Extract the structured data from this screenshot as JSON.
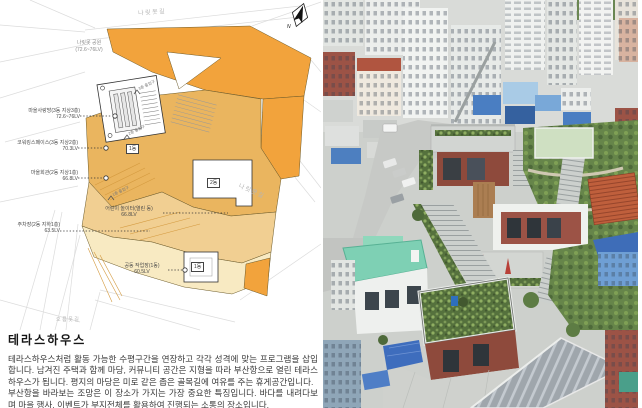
{
  "plan": {
    "compass_label": "N",
    "park": {
      "name": "나릿못 공원",
      "level": "(72.6~76LV)"
    },
    "streets": [
      {
        "text": "나릿못길"
      },
      {
        "text": "나릿못길"
      },
      {
        "text": "오름못길"
      }
    ],
    "callouts": [
      {
        "name": "마을사랑방(3동 지상3층)",
        "level": "72.6~76LV"
      },
      {
        "name": "코워킹스페이스(3동 지상2층)",
        "level": "70.3LV"
      },
      {
        "name": "마을회관(2동 지상1층)",
        "level": "66.8LV"
      },
      {
        "name": "주차장(2동 지하1층)",
        "level": "63.5LV"
      },
      {
        "name": "어린이 놀이터(열린 동)",
        "level": "66.8LV"
      },
      {
        "name": "공동 작업장(1동)",
        "level": "60.5LV"
      }
    ],
    "building_tags": [
      {
        "label": "1동"
      },
      {
        "label": "2동"
      },
      {
        "label": "1동"
      }
    ],
    "entrances": [
      {
        "text": "3층 출입구"
      },
      {
        "text": "2층 출입구"
      },
      {
        "text": "1층 출입구"
      }
    ],
    "colors": {
      "orange_bright": "#F2A33C",
      "orange_mid": "#EAB55F",
      "tan": "#F1CF92",
      "cream": "#F8EAC2"
    }
  },
  "description": {
    "title": "테라스하우스",
    "paragraphs": [
      "테라스하우스처럼 활동 가능한 수평구간을 연장하고 각각 성격에 맞는 프로그램을 삽입합니다. 남겨진 주택과 함께 마당, 커뮤니티 공간은 지형을 따라 부산항으로 열린 테라스하우스가 됩니다. 평지의 마당은 미로 같은 좁은 골목길에 여유를 주는 휴게공간입니다.",
      "부산항을 바라보는 조망은 이 장소가 가지는 가장 중요한 특징입니다. 바다를 내려다보며 마을 행사, 이벤트가 부지전체를 활용하여 진행되는 소통의 장소입니다."
    ]
  },
  "photo": {
    "palette": {
      "roof_blue": "#4a7ec2",
      "roof_mint": "#7ed0b4",
      "brick_red": "#8e4a3c",
      "roof_orange": "#bf5f3c",
      "greenery": "#5d7c44",
      "road_grey": "#c6c8c6",
      "building_white": "#eef0ee"
    }
  }
}
